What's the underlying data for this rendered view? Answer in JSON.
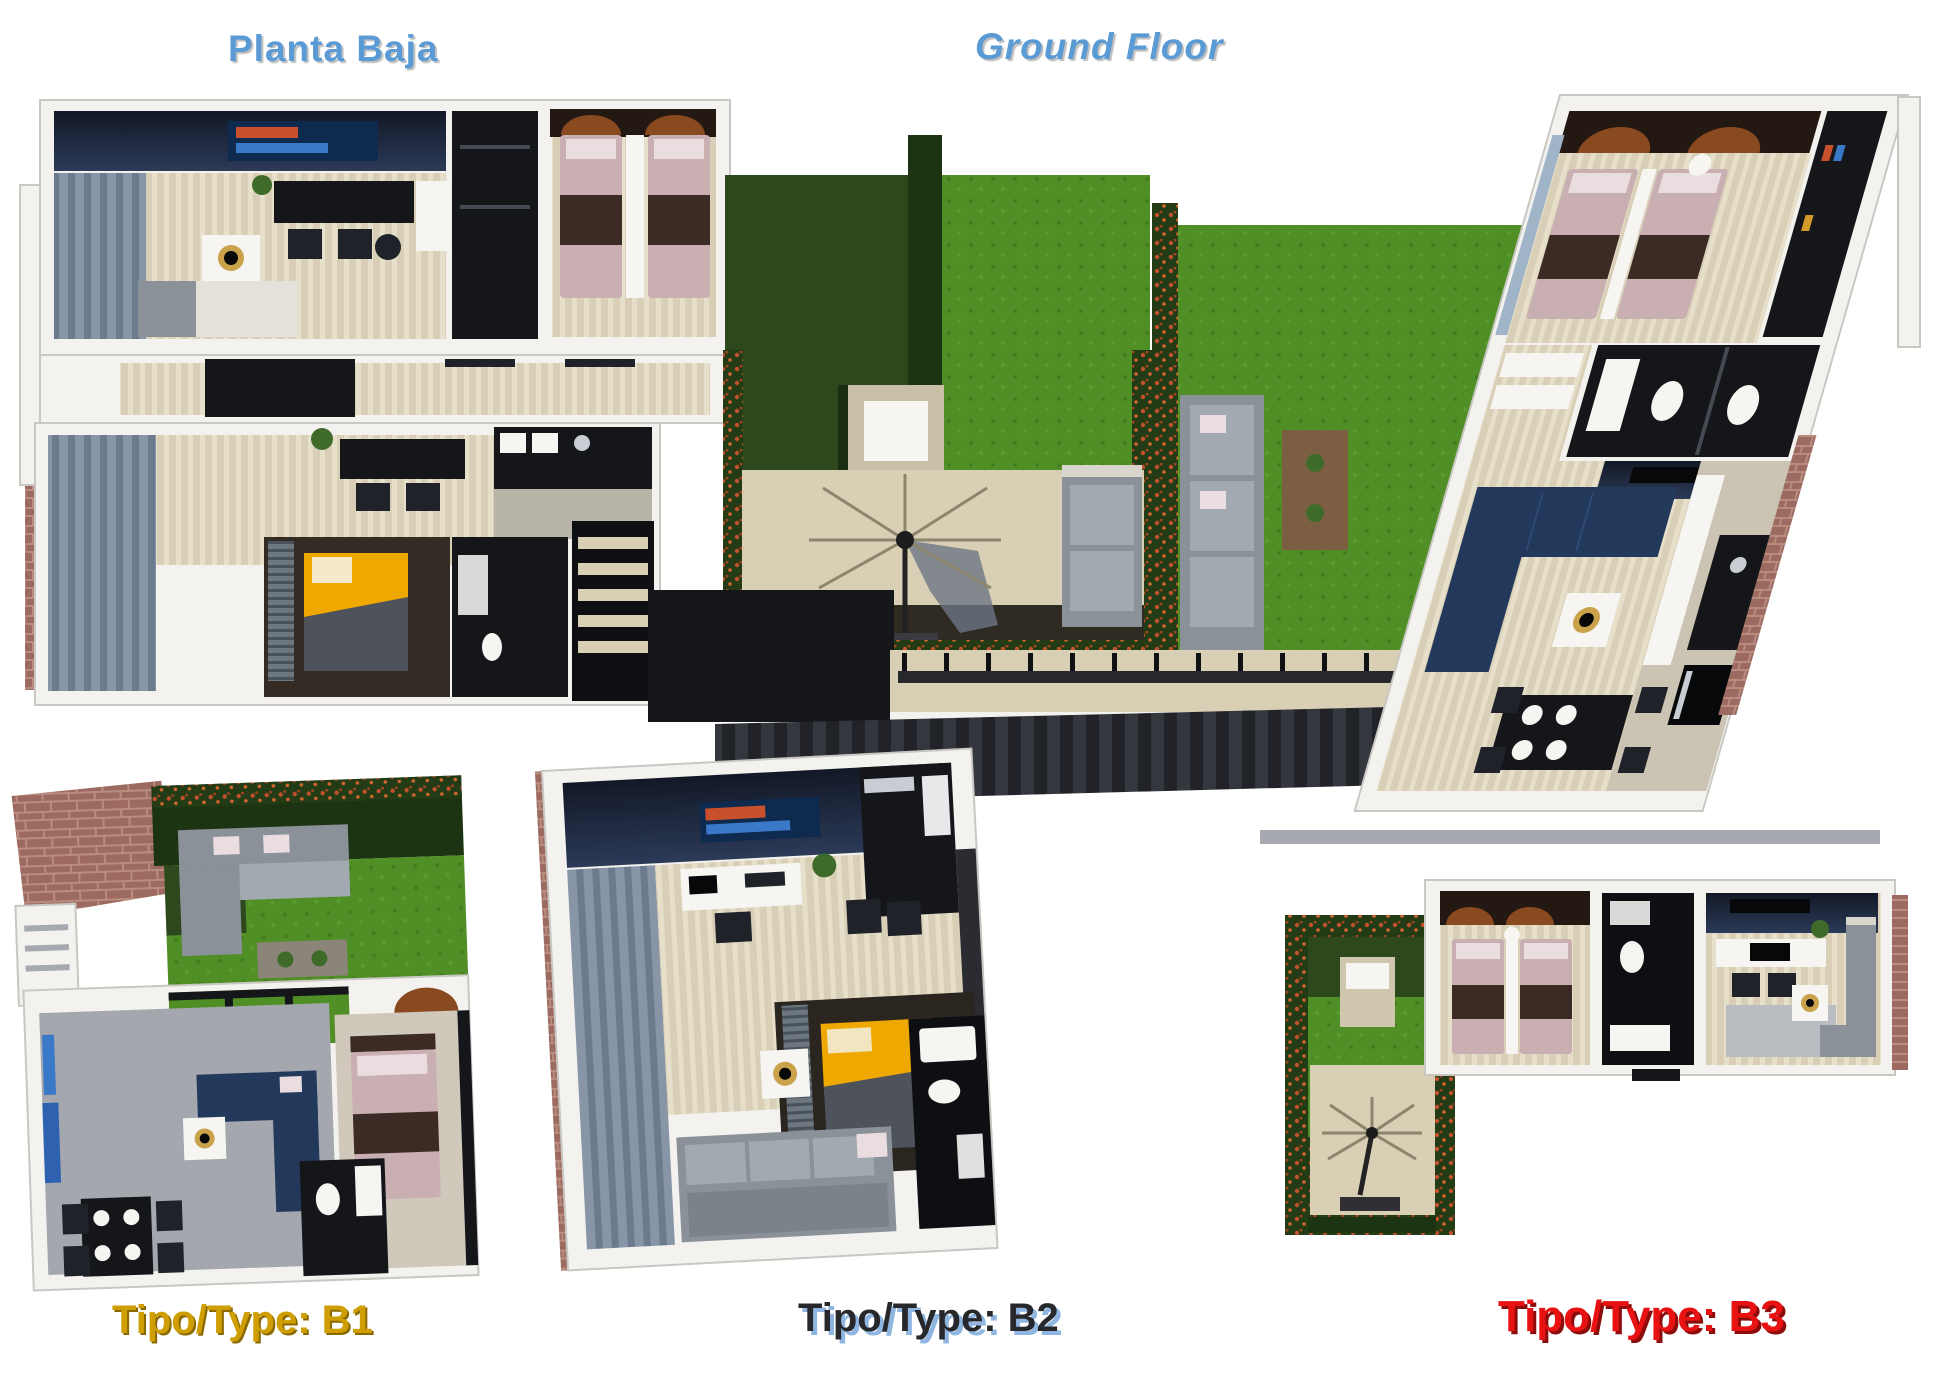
{
  "titles": {
    "planta_baja": "Planta Baja",
    "ground_floor": "Ground Floor"
  },
  "type_labels": {
    "b1": "Tipo/Type: B1",
    "b2": "Tipo/Type: B2",
    "b3": "Tipo/Type: B3"
  },
  "palette": {
    "title-blue": "#5b9bd5",
    "b1-gold": "#cf9e03",
    "b1-gold-shadow": "#8a6a00",
    "b2-dark": "#26282c",
    "b2-shadow": "#8fb6e0",
    "b3-red": "#e81212",
    "b3-shadow": "#8c0c0c",
    "wall": "#f3f2ef",
    "wall-edge": "#c8c7c2",
    "navy-1": "#121826",
    "navy-2": "#2c3a58",
    "floor-beige": "#d8cfb6",
    "curtain": "#8795a6",
    "curtain-dark": "#6b7a8d",
    "grass-light": "#4f8f26",
    "grass-dark": "#2c481c",
    "hedge-green": "#233c16",
    "hedge-flower": "#c2512c",
    "patio": "#d8cfb4",
    "brick": "#9c6a60",
    "sofa-gray": "#8b9199",
    "sofa-blue": "#23395c",
    "bed-pink": "#c9aeb2",
    "bed-brown": "#3c2b24",
    "bed-yellow": "#efa800",
    "copper": "#8a4a20",
    "black-furniture": "#15161a",
    "gold": "#c9a24a"
  }
}
